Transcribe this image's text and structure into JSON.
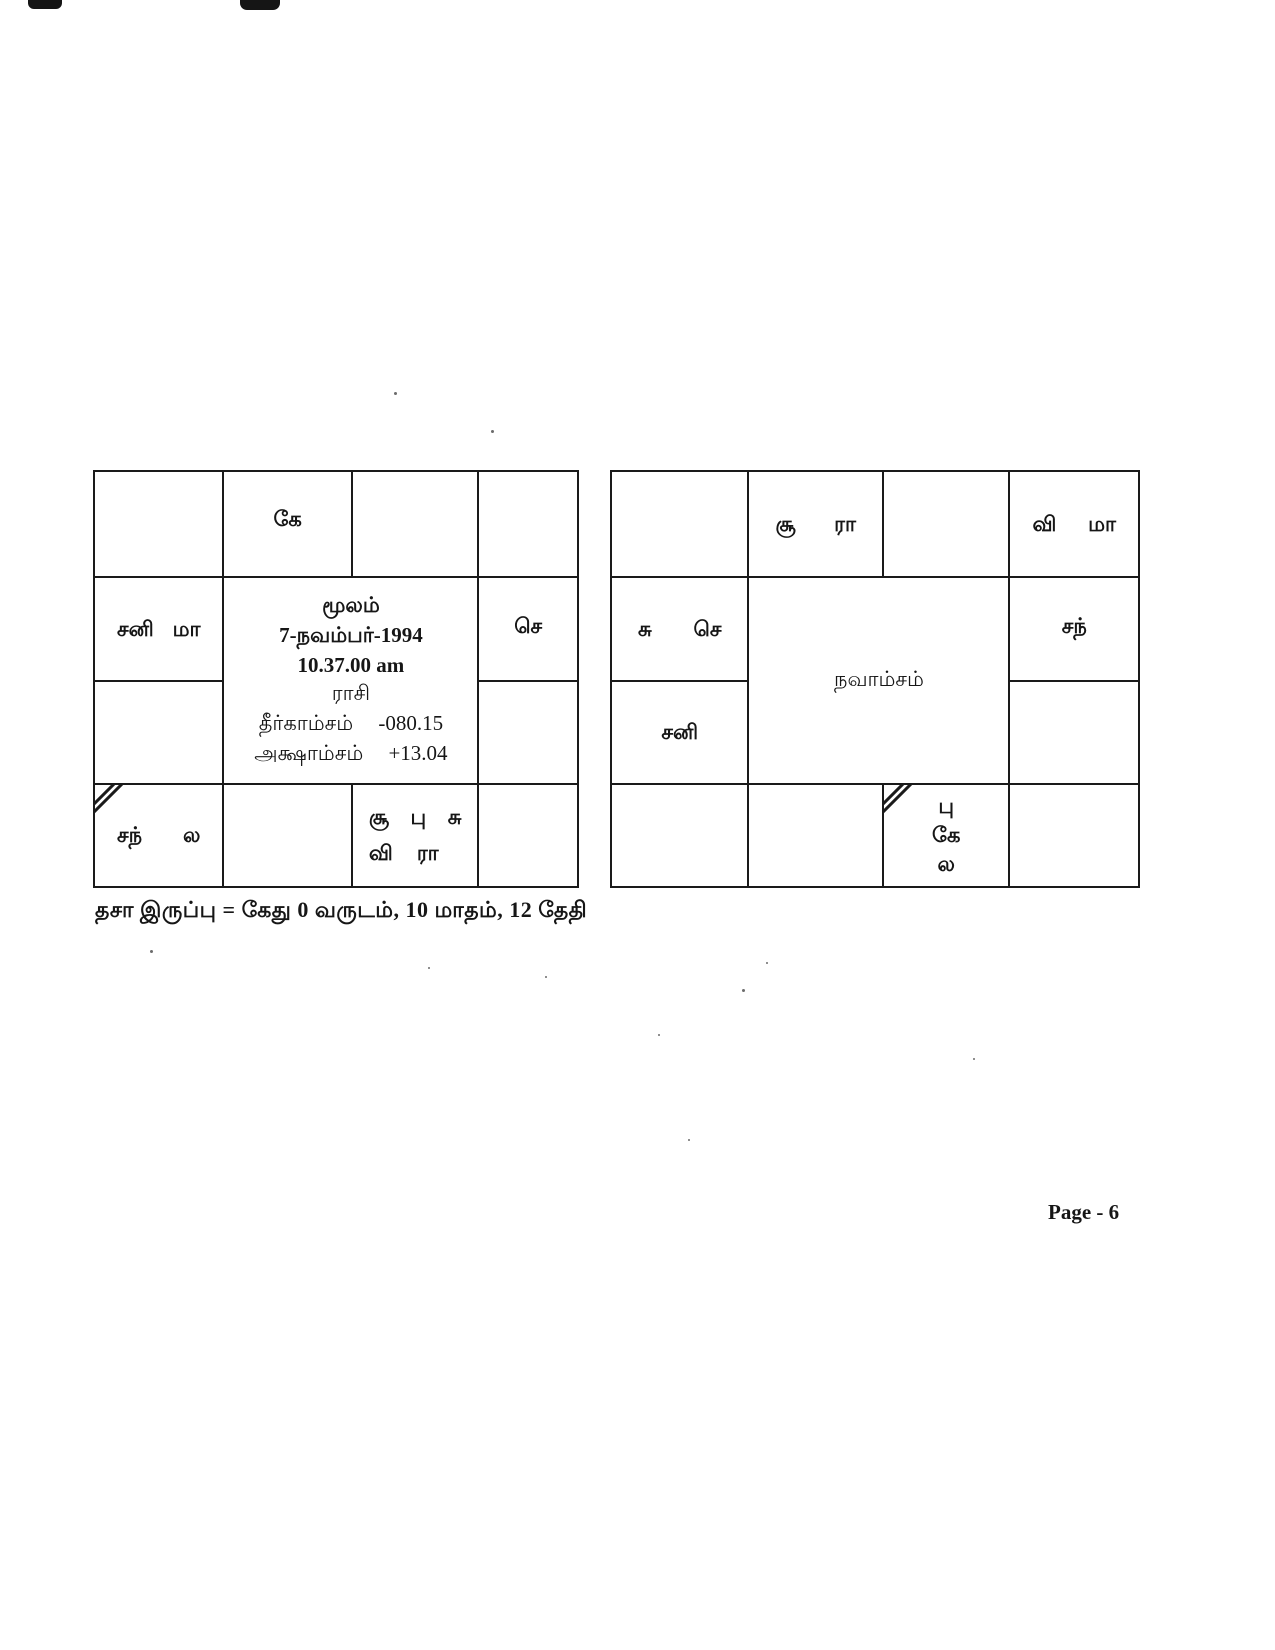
{
  "page": {
    "dasa_line": "தசா இருப்பு = கேது 0 வருடம், 10 மாதம், 12 தேதி",
    "page_number": "Page - 6"
  },
  "rasi": {
    "center": {
      "nakshatra": "மூலம்",
      "date": "7-நவம்பர்-1994",
      "time": "10.37.00 am",
      "chart_name": "ராசி",
      "longitude_label": "தீர்காம்சம்",
      "longitude_value": "-080.15",
      "latitude_label": "அக்ஷாம்சம்",
      "latitude_value": "+13.04"
    },
    "houses": {
      "ketu": "கே",
      "sani": "சனி",
      "mandhi": "மா",
      "sevvai": "செ",
      "chandran": "சந்",
      "lagnam": "ல",
      "suriyan": "சூ",
      "budhan": "பு",
      "sukran": "சு",
      "viyazhan": "வி",
      "rahu": "ரா"
    }
  },
  "navamsam": {
    "center": {
      "chart_name": "நவாம்சம்"
    },
    "houses": {
      "suriyan": "சூ",
      "rahu": "ரா",
      "viyazhan": "வி",
      "mandhi": "மா",
      "sukran": "சு",
      "sevvai": "செ",
      "sani": "சனி",
      "chandran": "சந்",
      "budhan": "பு",
      "ketu": "கே",
      "lagnam": "ல"
    }
  }
}
